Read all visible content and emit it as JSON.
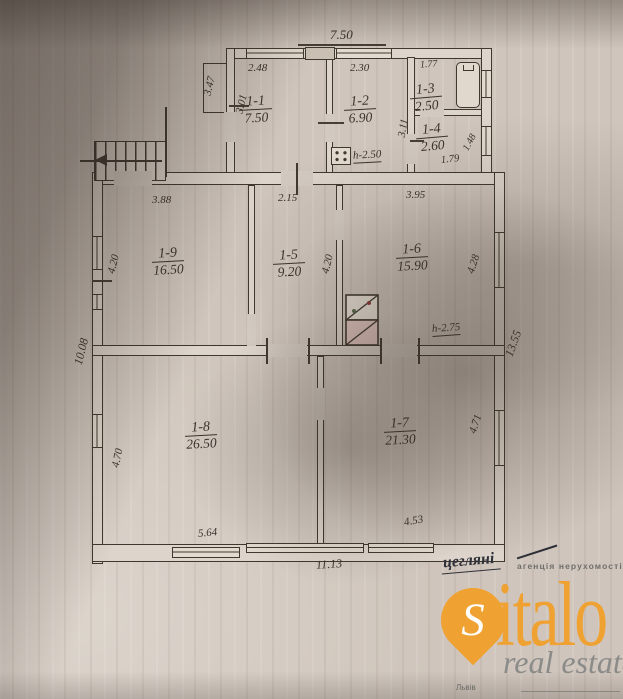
{
  "plan": {
    "type": "floor-plan",
    "rooms": [
      {
        "num": "1-1",
        "area": "7.50"
      },
      {
        "num": "1-2",
        "area": "6.90"
      },
      {
        "num": "1-3",
        "area": "2.50"
      },
      {
        "num": "1-4",
        "area": "2.60"
      },
      {
        "num": "1-5",
        "area": "9.20"
      },
      {
        "num": "1-6",
        "area": "15.90"
      },
      {
        "num": "1-7",
        "area": "21.30"
      },
      {
        "num": "1-8",
        "area": "26.50"
      },
      {
        "num": "1-9",
        "area": "16.50"
      }
    ],
    "dimensions": {
      "top_width": "7.50",
      "r11_w": "2.48",
      "r12_w": "2.30",
      "r13_w": "1.77",
      "upper_left_h": "3.47",
      "r11_h": "3.01",
      "col_h": "3.11",
      "r14_w": "1.79",
      "r14_right": "1.48",
      "r19_w": "3.88",
      "r15_w": "2.15",
      "r16_w": "3.95",
      "r19_h": "4.20",
      "r15_h": "4.20",
      "r16_h": "4.28",
      "left_total": "10.08",
      "right_total": "13.55",
      "r18_h": "4.70",
      "r18_w": "5.64",
      "r17_w": "4.53",
      "r17_h": "4.71",
      "bottom_total": "11.13"
    },
    "heights": {
      "upper_block": "h-2.50",
      "main_block": "h-2.75"
    },
    "note": "цегляні"
  },
  "watermark": {
    "pin_letter": "S",
    "brand_rest": "italo",
    "tagline_top": "агенція нерухомості",
    "tagline_bottom": "real estate",
    "city": "Львів",
    "accent_color": "#efa132",
    "ink_color": "#3a332b",
    "paper_color": "#cfc5bc"
  }
}
